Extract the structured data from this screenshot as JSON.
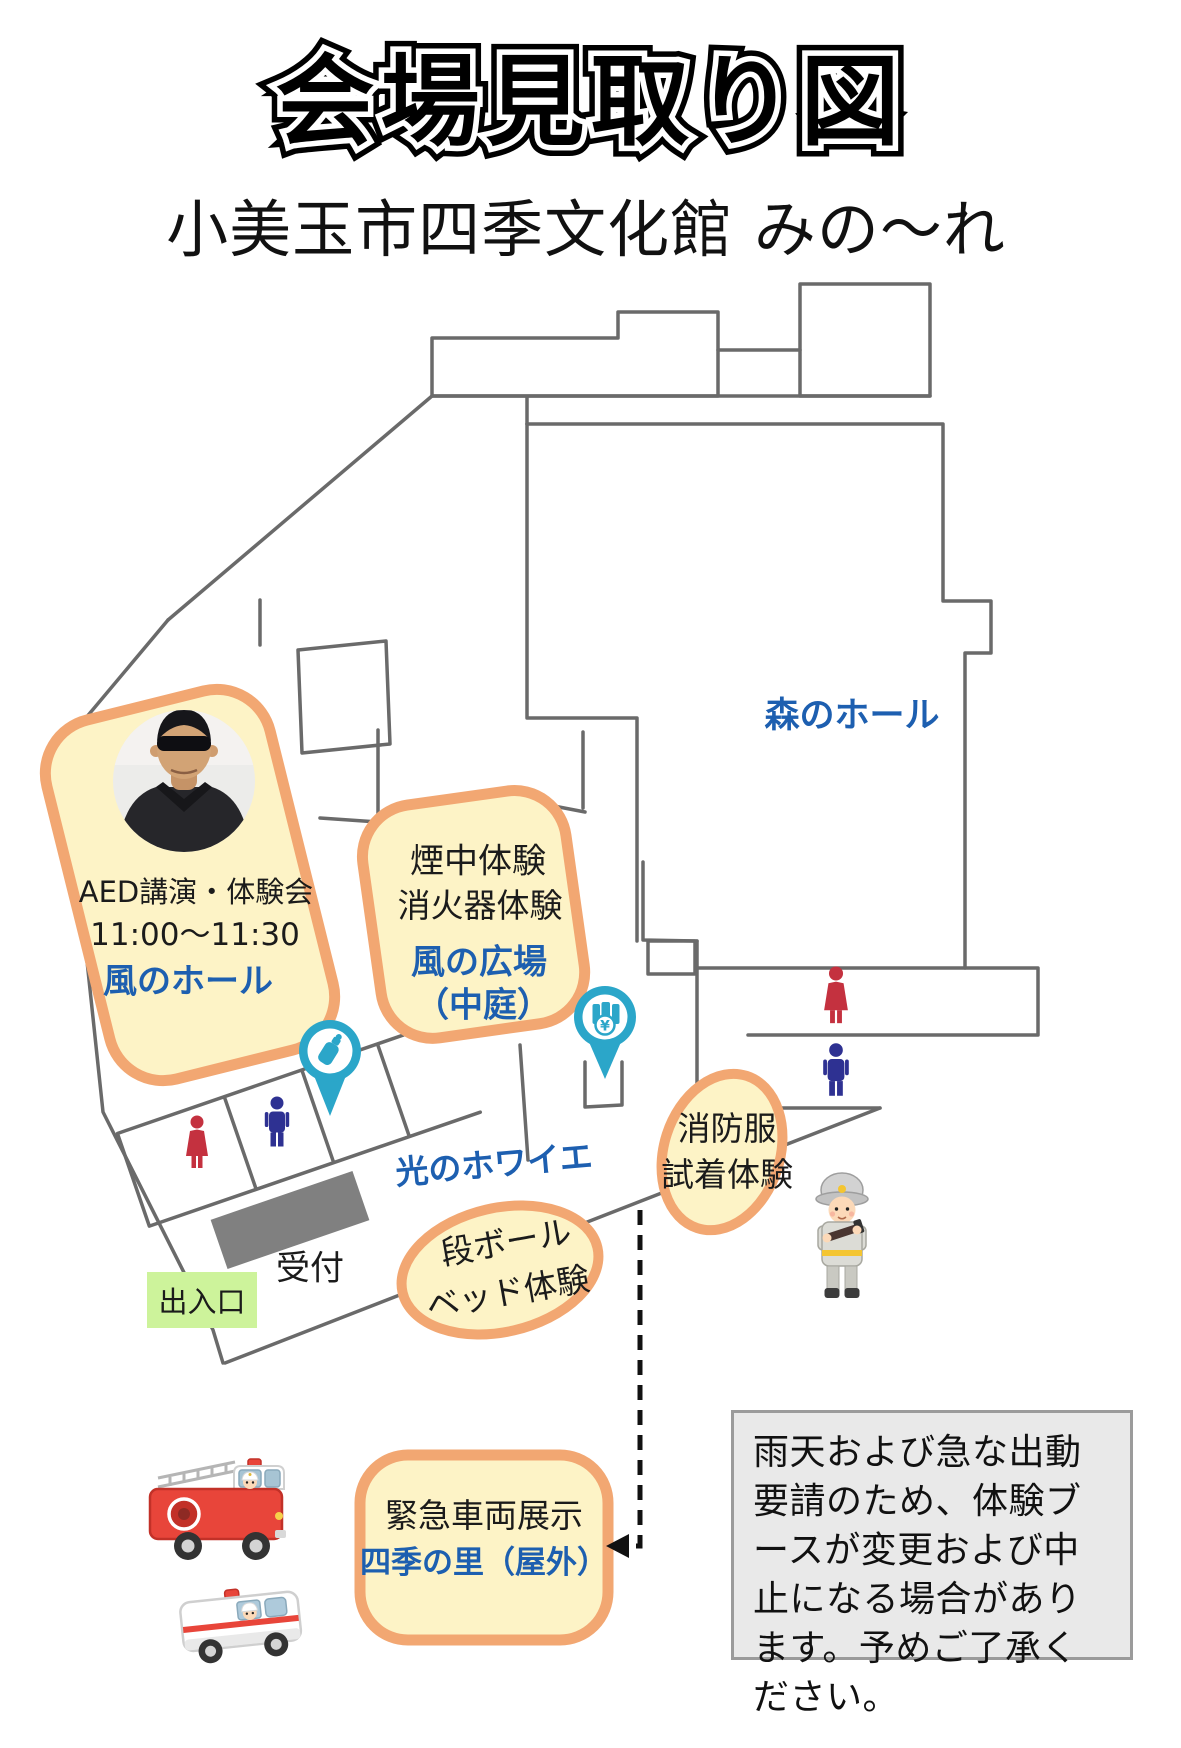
{
  "title": "会場見取り図",
  "subtitle": "小美玉市四季文化館 みの〜れ",
  "map": {
    "mori_hall_label": "森のホール",
    "aed": {
      "line1": "AED講演・体験会",
      "line2": "11:00〜11:30",
      "venue": "風のホール"
    },
    "smoke": {
      "line1": "煙中体験",
      "line2": "消火器体験",
      "venue1": "風の広場",
      "venue2": "（中庭）"
    },
    "foyer_label": "光のホワイエ",
    "fire_suit": {
      "line1": "消防服",
      "line2": "試着体験"
    },
    "cardboard_bed": {
      "line1": "段ボール",
      "line2": "ベッド体験"
    },
    "reception_label": "受付",
    "entrance_label": "出入口",
    "vehicles": {
      "line1": "緊急車両展示",
      "venue": "四季の里（屋外）"
    }
  },
  "note": "雨天および急な出動要請のため、体験ブースが変更および中止になる場合があります。予めご了承ください。",
  "icons": {
    "baby_bottle_pin": "baby-bottle-pin",
    "vending_pin": "drink-vending-pin",
    "female_restroom": "female-restroom",
    "male_restroom": "male-restroom",
    "yen_symbol": "¥"
  },
  "colors": {
    "accent_blue": "#1d5fb0",
    "highlight_border": "#f2a772",
    "highlight_fill": "#fdf3c6",
    "pin_teal": "#2ba6c9",
    "entrance_green": "#cdf39b",
    "wall_gray": "#6a6a6a",
    "female_red": "#c4313f",
    "male_navy": "#2e3192"
  }
}
